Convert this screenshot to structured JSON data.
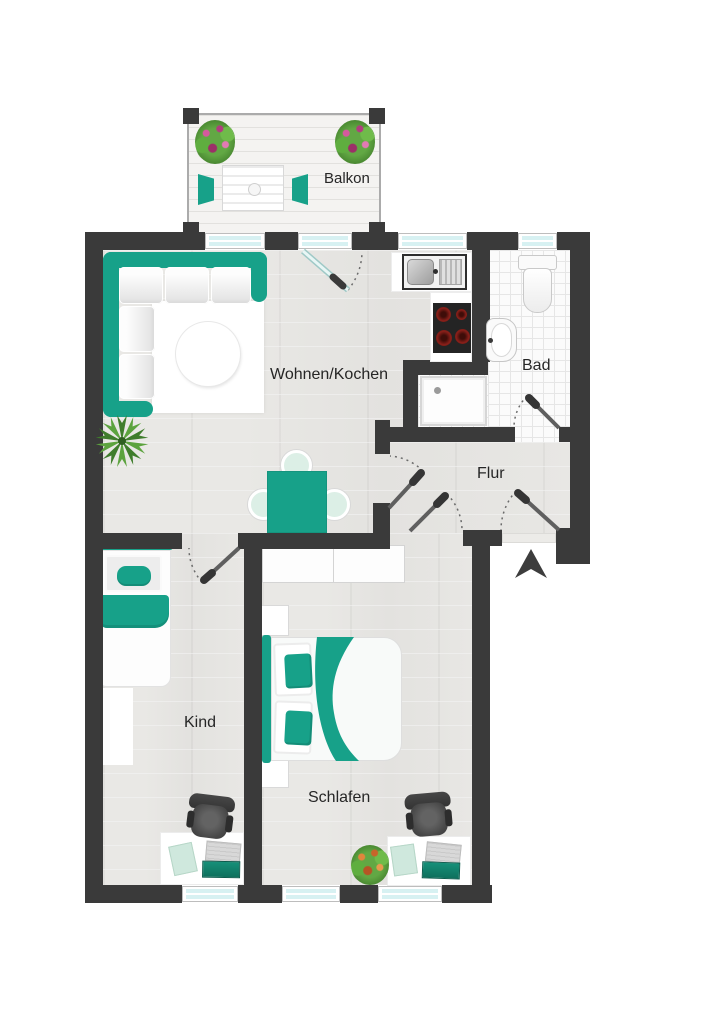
{
  "floorplan": {
    "type": "apartment-floor-plan",
    "rooms": {
      "balkon": {
        "label": "Balkon"
      },
      "wohnen_kochen": {
        "label": "Wohnen/Kochen"
      },
      "bad": {
        "label": "Bad"
      },
      "flur": {
        "label": "Flur"
      },
      "kind": {
        "label": "Kind"
      },
      "schlafen": {
        "label": "Schlafen"
      }
    },
    "colors": {
      "accent_teal": "#17A189",
      "wall_dark": "#3A3A3A",
      "window_glass": "#D7F1F2",
      "floor_wood": "#E7E6E3",
      "tile_white": "#FBFBFB"
    },
    "icons": {
      "north_arrow": "▲"
    }
  }
}
